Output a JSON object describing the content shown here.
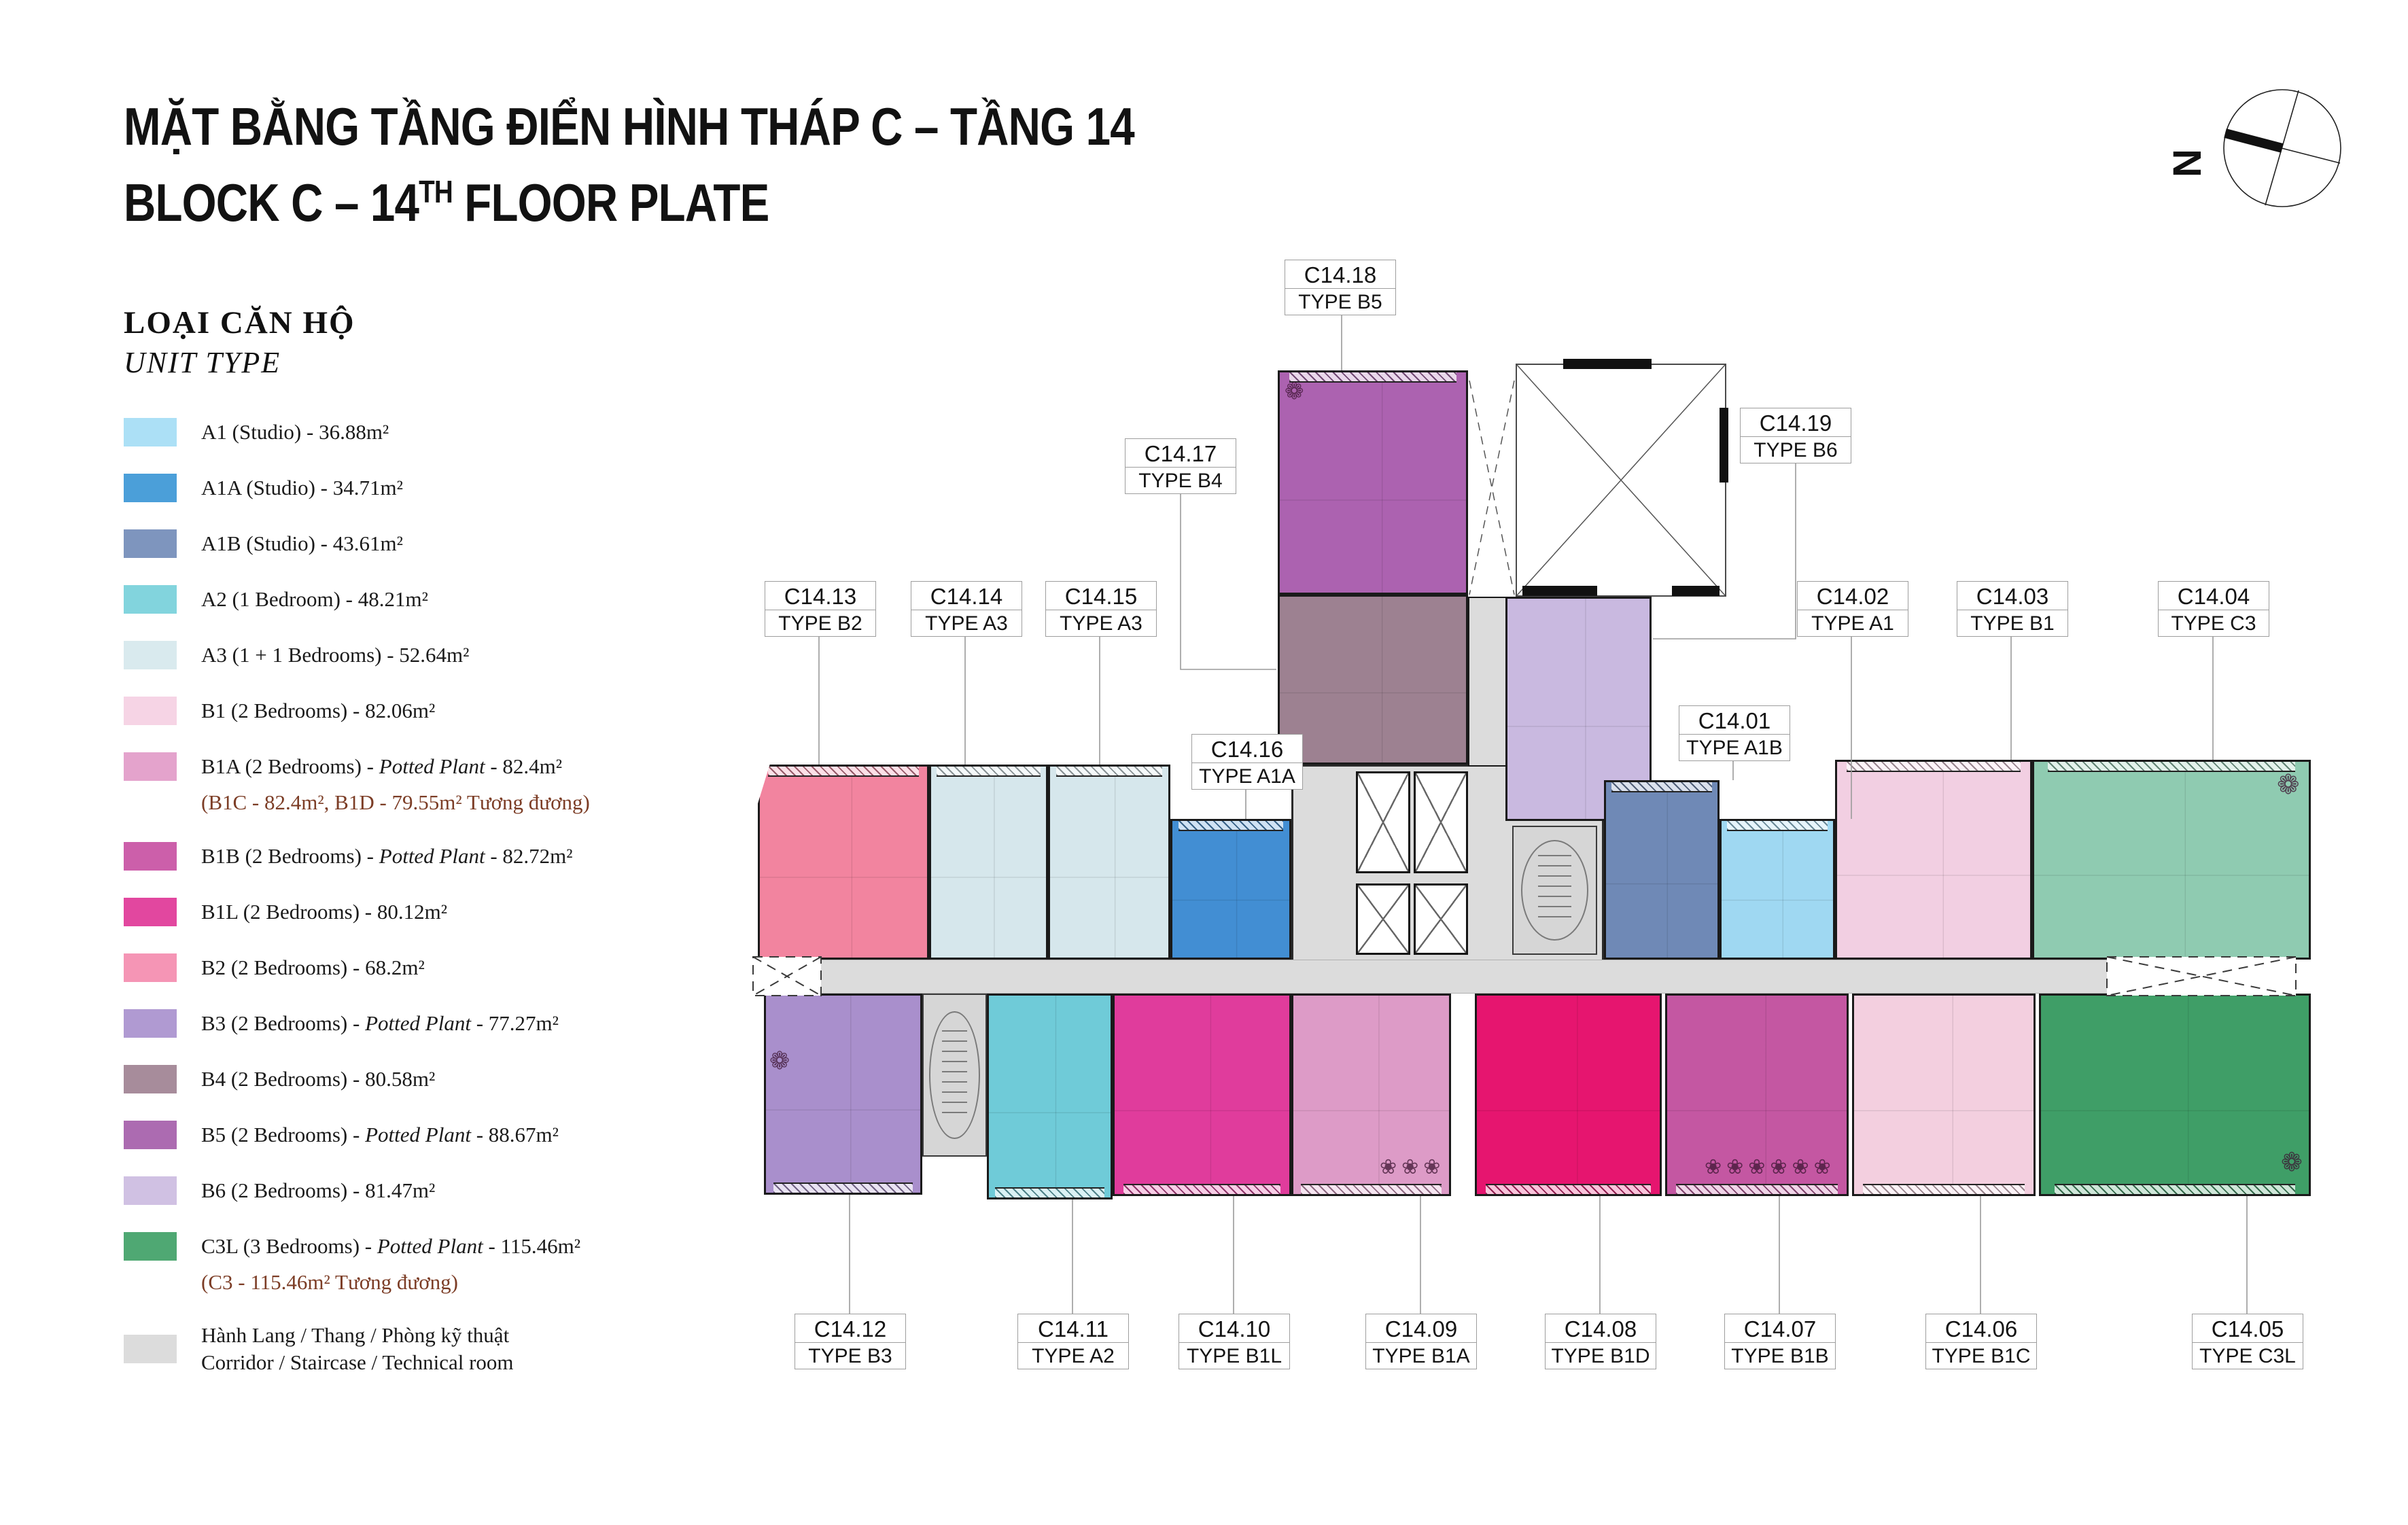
{
  "title": {
    "line1_vi": "MẶT BẰNG TẦNG ĐIỂN HÌNH THÁP C – TẦNG 14",
    "line2_pre": "BLOCK C – 14",
    "line2_sup": "TH",
    "line2_post": " FLOOR PLATE"
  },
  "compass": {
    "north_label": "N"
  },
  "legend": {
    "heading_vi": "LOẠI CĂN HỘ",
    "heading_en": "UNIT TYPE",
    "note_color": "#7c3d26",
    "items": [
      {
        "type": "A1",
        "color": "#ACE0F6",
        "pre": "A1 (Studio) - 36.88m²"
      },
      {
        "type": "A1A",
        "color": "#4B9FD9",
        "pre": "A1A (Studio) - 34.71m²"
      },
      {
        "type": "A1B",
        "color": "#7E95BE",
        "pre": "A1B (Studio) - 43.61m²"
      },
      {
        "type": "A2",
        "color": "#82D4DD",
        "pre": "A2 (1 Bedroom) - 48.21m²"
      },
      {
        "type": "A3",
        "color": "#D9EAEE",
        "pre": "A3 (1 + 1 Bedrooms) - 52.64m²"
      },
      {
        "type": "B1",
        "color": "#F6D4E5",
        "pre": "B1 (2 Bedrooms) - 82.06m²"
      },
      {
        "type": "B1A",
        "color": "#E4A3CC",
        "pre": "B1A (2 Bedrooms) - ",
        "italic": "Potted Plant",
        "post": " - 82.4m²",
        "note": "(B1C - 82.4m², B1D - 79.55m² Tương đương)"
      },
      {
        "type": "B1B",
        "color": "#CC5FAA",
        "pre": "B1B (2 Bedrooms) - ",
        "italic": "Potted Plant",
        "post": " - 82.72m²"
      },
      {
        "type": "B1L",
        "color": "#E2479F",
        "pre": "B1L (2 Bedrooms) - 80.12m²"
      },
      {
        "type": "B2",
        "color": "#F595B5",
        "pre": "B2 (2 Bedrooms) - 68.2m²"
      },
      {
        "type": "B3",
        "color": "#B09AD2",
        "pre": "B3 (2 Bedrooms) - ",
        "italic": "Potted Plant",
        "post": " - 77.27m²"
      },
      {
        "type": "B4",
        "color": "#A78C9B",
        "pre": "B4 (2 Bedrooms) - 80.58m²"
      },
      {
        "type": "B5",
        "color": "#AC6BB1",
        "pre": "B5 (2 Bedrooms) - ",
        "italic": "Potted Plant",
        "post": " - 88.67m²"
      },
      {
        "type": "B6",
        "color": "#D0C1E3",
        "pre": "B6 (2 Bedrooms) - 81.47m²"
      },
      {
        "type": "C3L",
        "color": "#4FA873",
        "pre": "C3L (3 Bedrooms) - ",
        "italic": "Potted Plant",
        "post": " - 115.46m²",
        "note": "(C3 - 115.46m² Tương đương)"
      },
      {
        "type": "CORR",
        "color": "#DCDCDC",
        "pre": "Hành Lang / Thang / Phòng kỹ thuật",
        "line2": "Corridor / Staircase / Technical room"
      }
    ]
  },
  "plan": {
    "unit_colors": {
      "A1": "#9FD8F2",
      "A1A": "#428ED3",
      "A1B": "#6F89B6",
      "A2": "#6FCBD8",
      "A3": "#D6E7EC",
      "B1": "#F2CFE2",
      "B1A": "#DD9BC7",
      "B1B": "#C457A2",
      "B1C": "#F3CFDF",
      "B1D": "#E6156F",
      "B1L": "#E03C9C",
      "B2": "#F2849F",
      "B3": "#A98FCC",
      "B4": "#9D8191",
      "B5": "#AC62B0",
      "B6": "#C9B9E0",
      "C3": "#8FCBB1",
      "C3L": "#3F9E67",
      "CORE": "#DCDCDC",
      "STAIR": "#D6D6D6"
    },
    "labels": [
      {
        "code": "C14.18",
        "type_label": "TYPE B5"
      },
      {
        "code": "C14.17",
        "type_label": "TYPE B4"
      },
      {
        "code": "C14.19",
        "type_label": "TYPE B6"
      },
      {
        "code": "C14.13",
        "type_label": "TYPE B2"
      },
      {
        "code": "C14.14",
        "type_label": "TYPE A3"
      },
      {
        "code": "C14.15",
        "type_label": "TYPE A3"
      },
      {
        "code": "C14.16",
        "type_label": "TYPE A1A"
      },
      {
        "code": "C14.01",
        "type_label": "TYPE A1B"
      },
      {
        "code": "C14.02",
        "type_label": "TYPE A1"
      },
      {
        "code": "C14.03",
        "type_label": "TYPE B1"
      },
      {
        "code": "C14.04",
        "type_label": "TYPE C3"
      },
      {
        "code": "C14.12",
        "type_label": "TYPE B3"
      },
      {
        "code": "C14.11",
        "type_label": "TYPE A2"
      },
      {
        "code": "C14.10",
        "type_label": "TYPE B1L"
      },
      {
        "code": "C14.09",
        "type_label": "TYPE B1A"
      },
      {
        "code": "C14.08",
        "type_label": "TYPE B1D"
      },
      {
        "code": "C14.07",
        "type_label": "TYPE B1B"
      },
      {
        "code": "C14.06",
        "type_label": "TYPE B1C"
      },
      {
        "code": "C14.05",
        "type_label": "TYPE C3L"
      }
    ]
  }
}
